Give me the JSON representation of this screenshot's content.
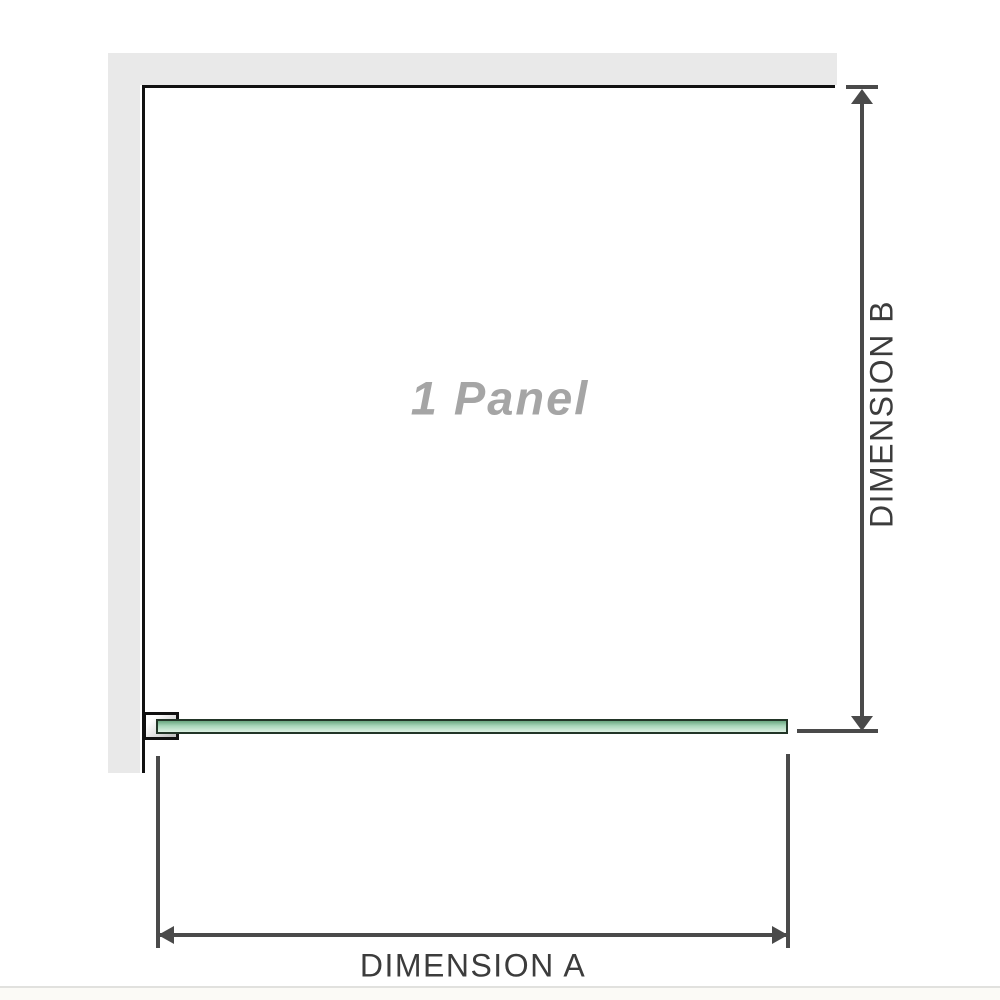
{
  "labels": {
    "panel": "1 Panel",
    "dimension_a": "DIMENSION A",
    "dimension_b": "DIMENSION B"
  },
  "colors": {
    "wall": "#e9e9e9",
    "panel_outline": "#111111",
    "glass_green_dark": "#6aa881",
    "glass_green_light": "#ddf1e3",
    "glass_outline": "#223527",
    "dimension_line": "#4a4a4a",
    "dimension_text": "#3c3c3c",
    "panel_label_text": "#a5a5a5"
  }
}
